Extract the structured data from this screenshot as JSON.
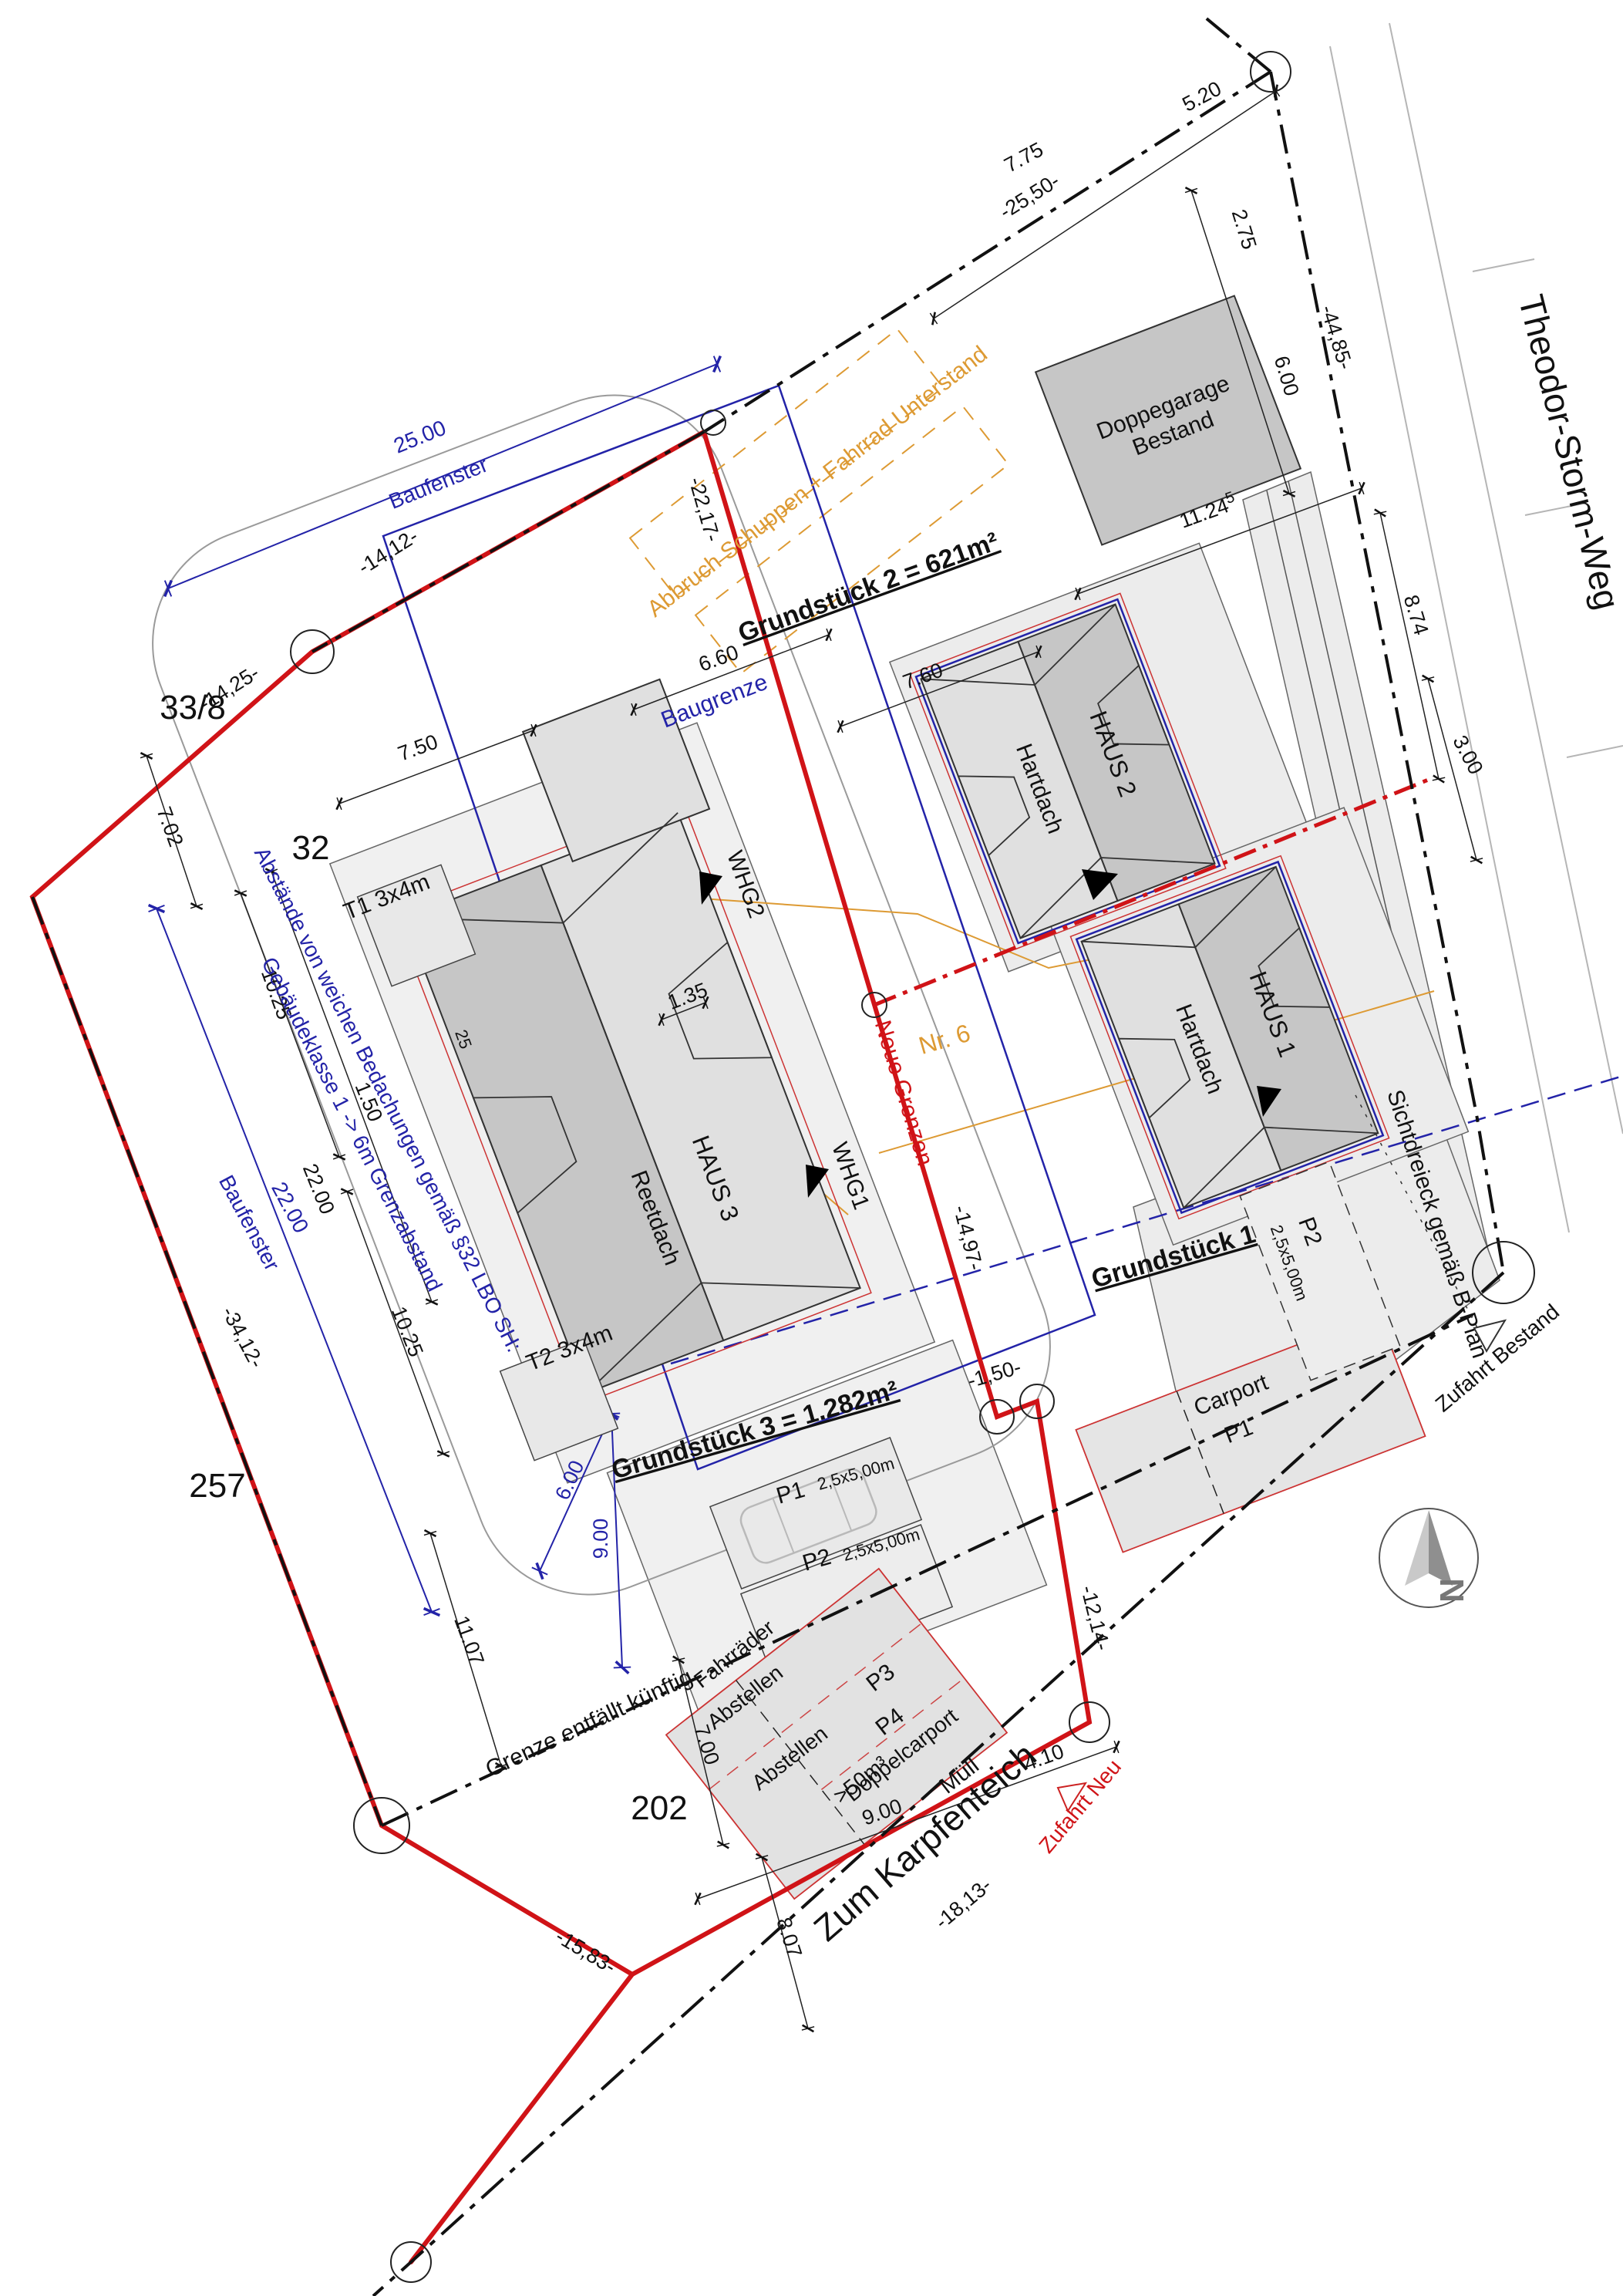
{
  "streets": {
    "theodor": "Theodor-Storm-Weg",
    "karpfenteich": "Zum Karpfenteich"
  },
  "parcels": {
    "n33_8": "33/8",
    "n32": "32",
    "n257": "257",
    "n202": "202",
    "nr6": "Nr. 6"
  },
  "plots": {
    "g1": "Grundstück 1",
    "g2": "Grundstück 2 = 621m²",
    "g3": "Grundstück 3 = 1.282m²"
  },
  "buildings": {
    "garage_line1": "Doppegarage",
    "garage_line2": "Bestand",
    "haus1": "HAUS 1",
    "haus1_roof": "Hartdach",
    "haus2": "HAUS 2",
    "haus2_roof": "Hartdach",
    "haus3": "HAUS 3",
    "haus3_roof": "Reetdach",
    "t1": "T1 3x4m",
    "t2": "T2 3x4m",
    "whg1": "WHG1",
    "whg2": "WHG2"
  },
  "parking": {
    "p1": "P1",
    "p1_size": "2,5x5,00m",
    "p2": "P2",
    "p2_size": "2,5x5,00m",
    "p2_g1": "P2",
    "p2_g1_size": "2,5x5,00m",
    "p3": "P3",
    "p4": "P4",
    "p4_type": "Doppelcarport",
    "p4_vol": ">50m³",
    "muell": "Müll",
    "carport": "Carport",
    "carport_stall": "P1",
    "bikes1": "Fahrräder",
    "bikes2": "Abstellen",
    "abstellen": "Abstellen"
  },
  "notes": {
    "baugrenze": "Baugrenze",
    "baufenster_top": "Baufenster",
    "baufenster_left": "Baufenster",
    "abstand1": "Abstände von weichen Bedachungen gemäß §32 LBO SH:",
    "abstand2": "Gebäudeklasse 1 -> 6m Grenzabstand",
    "abbruch": "Abbruch Schuppen + Fahrrad Unterstand",
    "neue_grenzen": "Neue Grenzen",
    "grenze_entf": "Grenze entfällt künftig",
    "sicht": "Sichtdreieck gemäß B-Plan",
    "zufahrt_neu": "Zufahrt Neu",
    "zufahrt_bestand": "Zufahrt Bestand",
    "north": "N"
  },
  "dims": {
    "d25_00": "25.00",
    "d22_00_blue": "22.00",
    "d5_20": "5.20",
    "d7_75": "7.75",
    "d25_50": "-25,50-",
    "d2_75": "2.75",
    "d6_00": "6.00",
    "d44_85": "-44,85-",
    "d11_24": "11.24",
    "d11_24_sup": "5",
    "d8_74": "8.74",
    "d3_00": "3.00",
    "d7_60": "7.60",
    "d6_60": "6.60",
    "d7_50": "7.50",
    "d22_17": "-22,17-",
    "d14_12": "-14,12-",
    "d14_25": "-14,25-",
    "d7_02": "7.02",
    "d10_25_1": "10.25",
    "d10_25_2": "10.25",
    "d1_50": "1.50",
    "d22_00": "22.00",
    "d34_12": "-34,12-",
    "d1_35": "1.35",
    "d25": "25",
    "d14_97": "-14,97-",
    "dm1_50": "-1,50-",
    "d12_14": "-12,14-",
    "d11_07": "11.07",
    "d7_00": "7.00",
    "d6_00_blue": "6.00",
    "d9_00_blue": "9.00",
    "d8_07": "8.07",
    "d15_83": "-15,83-",
    "d18_13": "-18,13-",
    "d9_00": "9.00",
    "d4_10": "4.10"
  },
  "colors": {
    "boundary_new": "#d01317",
    "boundary_old": "#111111",
    "baugrenze_blue": "#2323a8",
    "demolition_orange": "#dd9a33",
    "building_dark": "#c6c6c6",
    "building_light": "#e0e0e0",
    "pavement": "#ececec"
  }
}
